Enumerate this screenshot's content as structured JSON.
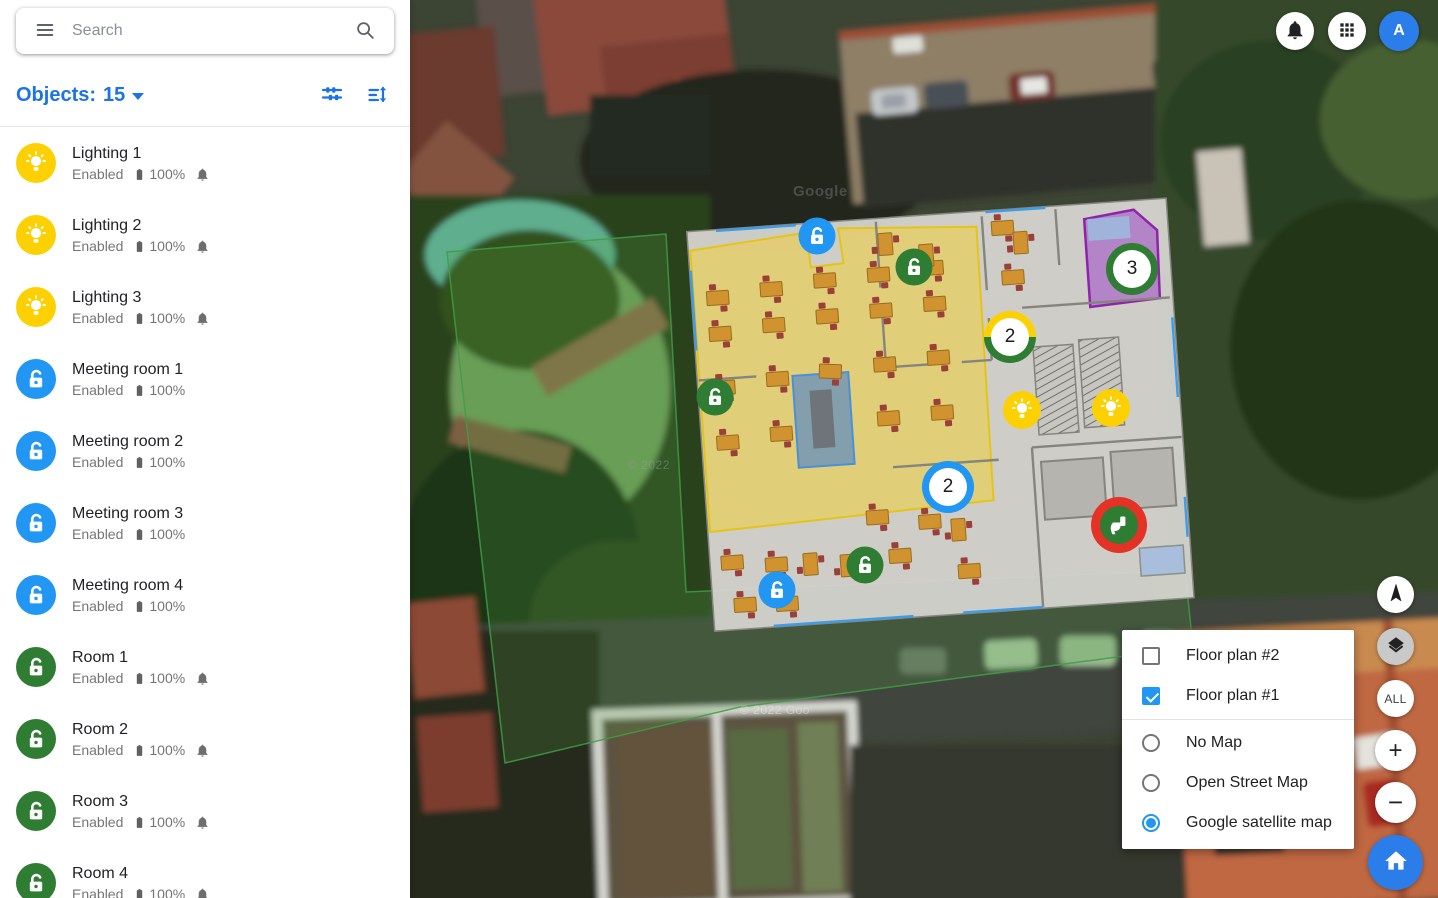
{
  "colors": {
    "accent_blue": "#1a73e8",
    "control_blue": "#2196F3",
    "lighting_yellow": "#fdd101",
    "meeting_blue": "#2196F3",
    "room_green": "#2e7d32",
    "toilet_red": "#e53226",
    "avatar_blue": "#2b7de9",
    "purple_zone": "#9c27b0",
    "yellow_zone_border": "#e6c417"
  },
  "icons": {
    "menu": "hamburger-menu",
    "search": "magnifier",
    "filter": "tune-sliders",
    "sort": "sort-amount-arrows",
    "notifications": "bell",
    "apps": "grid-3x3",
    "battery": "battery-full",
    "alert_bell": "small-bell",
    "compass": "navigation-arrow",
    "layers": "stacked-layers",
    "home": "house",
    "zoom_in": "plus",
    "zoom_out": "minus",
    "lock": "open-padlock",
    "bulb": "lightbulb",
    "toilet": "toilet-wc"
  },
  "topbar": {
    "avatar_label": "A"
  },
  "sidebar": {
    "search": {
      "placeholder": "Search"
    },
    "header": {
      "label": "Objects:",
      "count": "15"
    },
    "items": [
      {
        "name": "Lighting 1",
        "status": "Enabled",
        "battery": "100%",
        "type": "bulb",
        "bell": true
      },
      {
        "name": "Lighting 2",
        "status": "Enabled",
        "battery": "100%",
        "type": "bulb",
        "bell": true
      },
      {
        "name": "Lighting 3",
        "status": "Enabled",
        "battery": "100%",
        "type": "bulb",
        "bell": true
      },
      {
        "name": "Meeting room 1",
        "status": "Enabled",
        "battery": "100%",
        "type": "lock-blue",
        "bell": false
      },
      {
        "name": "Meeting room 2",
        "status": "Enabled",
        "battery": "100%",
        "type": "lock-blue",
        "bell": false
      },
      {
        "name": "Meeting room 3",
        "status": "Enabled",
        "battery": "100%",
        "type": "lock-blue",
        "bell": false
      },
      {
        "name": "Meeting room 4",
        "status": "Enabled",
        "battery": "100%",
        "type": "lock-blue",
        "bell": false
      },
      {
        "name": "Room 1",
        "status": "Enabled",
        "battery": "100%",
        "type": "lock-green",
        "bell": true
      },
      {
        "name": "Room 2",
        "status": "Enabled",
        "battery": "100%",
        "type": "lock-green",
        "bell": true
      },
      {
        "name": "Room 3",
        "status": "Enabled",
        "battery": "100%",
        "type": "lock-green",
        "bell": true
      },
      {
        "name": "Room 4",
        "status": "Enabled",
        "battery": "100%",
        "type": "lock-green",
        "bell": true
      }
    ]
  },
  "map": {
    "watermarks": [
      "Google",
      "© 2022",
      "© 2022 Goo"
    ],
    "controls": {
      "all_label": "ALL",
      "zoom_in_label": "+",
      "zoom_out_label": "−"
    },
    "layers_panel": {
      "checkboxes": [
        {
          "label": "Floor plan #2",
          "checked": false
        },
        {
          "label": "Floor plan #1",
          "checked": true
        }
      ],
      "radios": [
        {
          "label": "No Map",
          "selected": false
        },
        {
          "label": "Open Street Map",
          "selected": false
        },
        {
          "label": "Google satellite map",
          "selected": true
        }
      ]
    },
    "markers": [
      {
        "type": "lock",
        "color": "meeting_blue",
        "x": 817,
        "y": 236
      },
      {
        "type": "lock",
        "color": "room_green",
        "x": 914,
        "y": 267
      },
      {
        "type": "cluster",
        "style": "green",
        "label": "3",
        "x": 1132,
        "y": 269
      },
      {
        "type": "cluster",
        "style": "yellow-green",
        "label": "2",
        "x": 1010,
        "y": 337
      },
      {
        "type": "lock",
        "color": "room_green",
        "x": 715,
        "y": 397
      },
      {
        "type": "bulb",
        "x": 1022,
        "y": 410
      },
      {
        "type": "bulb",
        "x": 1111,
        "y": 408
      },
      {
        "type": "cluster",
        "style": "blue",
        "label": "2",
        "x": 948,
        "y": 487
      },
      {
        "type": "toilet",
        "x": 1119,
        "y": 525
      },
      {
        "type": "lock",
        "color": "room_green",
        "x": 865,
        "y": 565
      },
      {
        "type": "lock",
        "color": "meeting_blue",
        "x": 777,
        "y": 590
      }
    ]
  }
}
